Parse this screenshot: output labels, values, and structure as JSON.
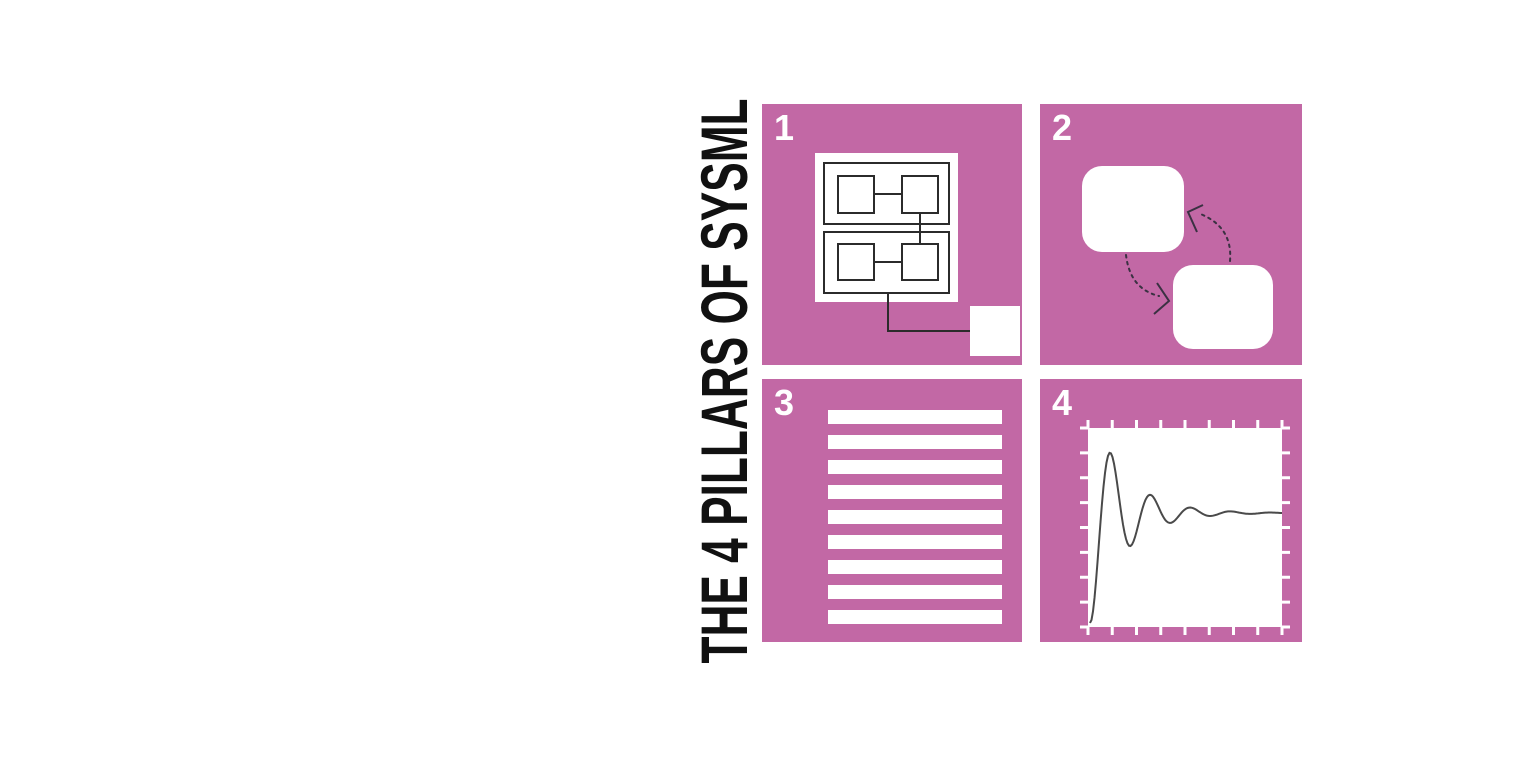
{
  "title": {
    "text": "THE 4 PILLARS OF SYSML"
  },
  "theme": {
    "background": "#ffffff",
    "title_color": "#111111",
    "tile_color": "#c268a5",
    "tile_number_color": "#ffffff",
    "diagram_line_color": "#2b2b2b",
    "arrow_color": "#3a3142",
    "curve_color": "#4a4a4a"
  },
  "tiles": [
    {
      "number": "1",
      "icon": "block-definition-diagram-icon"
    },
    {
      "number": "2",
      "icon": "behavior-interaction-diagram-icon"
    },
    {
      "number": "3",
      "icon": "requirements-text-lines-icon",
      "bars": {
        "count": 9,
        "x": 66,
        "width": 174,
        "first_y": 31,
        "pitch": 25,
        "height": 14
      }
    },
    {
      "number": "4",
      "icon": "parametric-response-plot-icon",
      "plot": {
        "ticks_per_side": 9,
        "area": {
          "x": 48,
          "y": 49,
          "width": 194,
          "height": 199
        },
        "curve": {
          "type": "damped-step-response",
          "x_start": 50,
          "x_end": 242,
          "y_base": 244,
          "y_steady": 134,
          "sigma": 0.03,
          "omega": 0.157
        }
      }
    }
  ]
}
